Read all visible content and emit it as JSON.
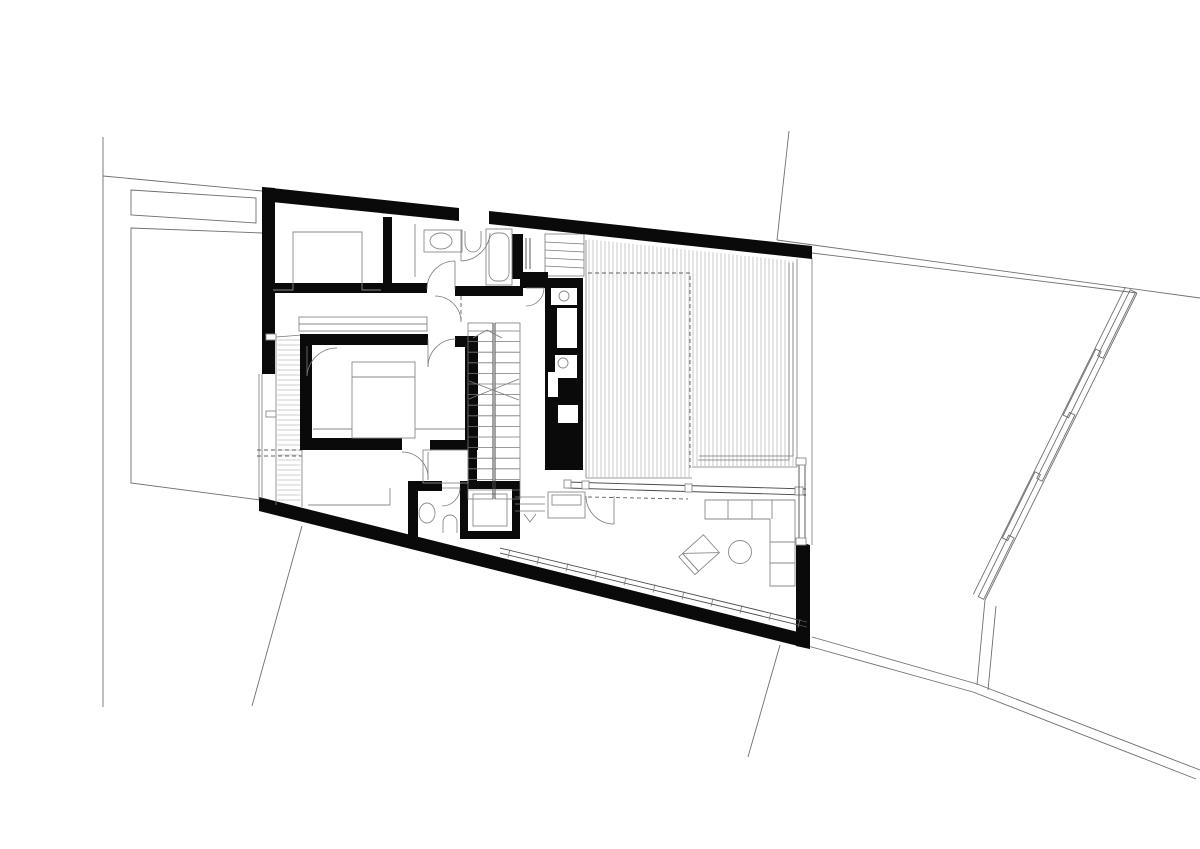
{
  "page": {
    "background": "#ffffff",
    "canvas": {
      "width": 1200,
      "height": 849
    }
  },
  "drawing": {
    "kind": "architectural floor plan",
    "style": "black and white CAD line drawing, no text labels",
    "colors": {
      "background": "#ffffff",
      "wall": "#0a0a0a",
      "line": "#4a4a4a",
      "thin": "#7a7a7a",
      "site": "#6f6f6f",
      "furniture": "#8a8a8a",
      "hatch": "#9d9d9d",
      "dashed": "#5f5f5f"
    },
    "features": {
      "site": [
        "property-boundary-lines",
        "planter-strip",
        "side-yard",
        "neighbor-fence-panels",
        "garden-wall"
      ],
      "building": [
        "perimeter-walls",
        "exterior-stair-strip",
        "entry-steps",
        "roof-deck-with-wood-decking",
        "deck-railing",
        "roof-overhang-dashed"
      ],
      "rooms": [
        "bedroom-1",
        "bathroom",
        "master-bedroom",
        "bedroom-2",
        "wc",
        "shower-room",
        "duct-rooms",
        "hall",
        "staircase",
        "living-room"
      ],
      "fixtures": [
        "bathtub",
        "washbasin",
        "toilet",
        "wc-toilet",
        "pedestal-basin",
        "shower-tray",
        "floor-drains"
      ],
      "furniture": [
        "double-bed",
        "wardrobe",
        "closet-niche",
        "corner-sofa",
        "round-coffee-table",
        "lounge-chair",
        "sideboard"
      ],
      "glazing": [
        "deck-window-band",
        "south-sliding-glazing",
        "east-window-band",
        "entry-glazing"
      ]
    },
    "stair": {
      "flights": 2,
      "treads_per_flight": 16,
      "direction_arrow": "up"
    },
    "deck_hatch": {
      "orientation": "vertical",
      "spacing_px": 4
    },
    "exterior_stair_hatch": {
      "orientation": "horizontal",
      "spacing_px": 5
    },
    "fence": {
      "panels": 5,
      "style": "staggered overlapping planks"
    }
  }
}
